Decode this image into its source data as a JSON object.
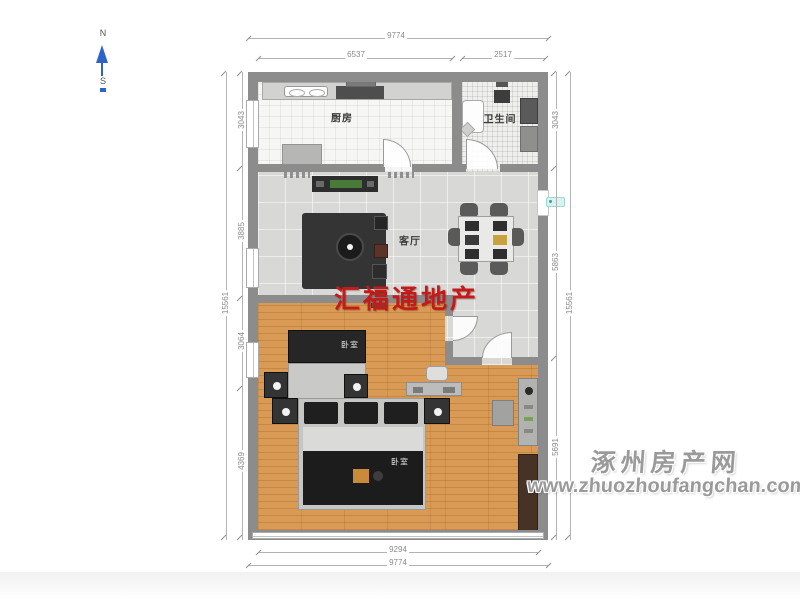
{
  "compass": {
    "north": "N",
    "south": "S"
  },
  "rooms": {
    "kitchen": "厨房",
    "bathroom": "卫生间",
    "living_room": "客厅",
    "bedroom_mid": "卧室",
    "bedroom_bottom": "卧室"
  },
  "dimensions": {
    "top": {
      "overall": "9774",
      "segment_left": "6537",
      "segment_right": "2517"
    },
    "bottom": {
      "inner": "9294",
      "overall": "9774"
    },
    "left": {
      "overall": "15561",
      "segments": [
        "3043",
        "3885",
        "3064",
        "4369"
      ]
    },
    "right": {
      "overall": "15561",
      "segments": [
        "3043",
        "5863",
        "5691"
      ]
    }
  },
  "watermarks": {
    "agency": "汇福通地产",
    "site_name": "涿州房产网",
    "site_url": "www.zhuozhoufangchan.com"
  },
  "colors": {
    "wall": "#8c8c8c",
    "wood_floor": "#d99a55",
    "tile_floor": "#d8d8d6",
    "agency_red": "#c41a1a",
    "compass_blue": "#2e64c8",
    "watermark_gray": "#9a9a9a"
  }
}
